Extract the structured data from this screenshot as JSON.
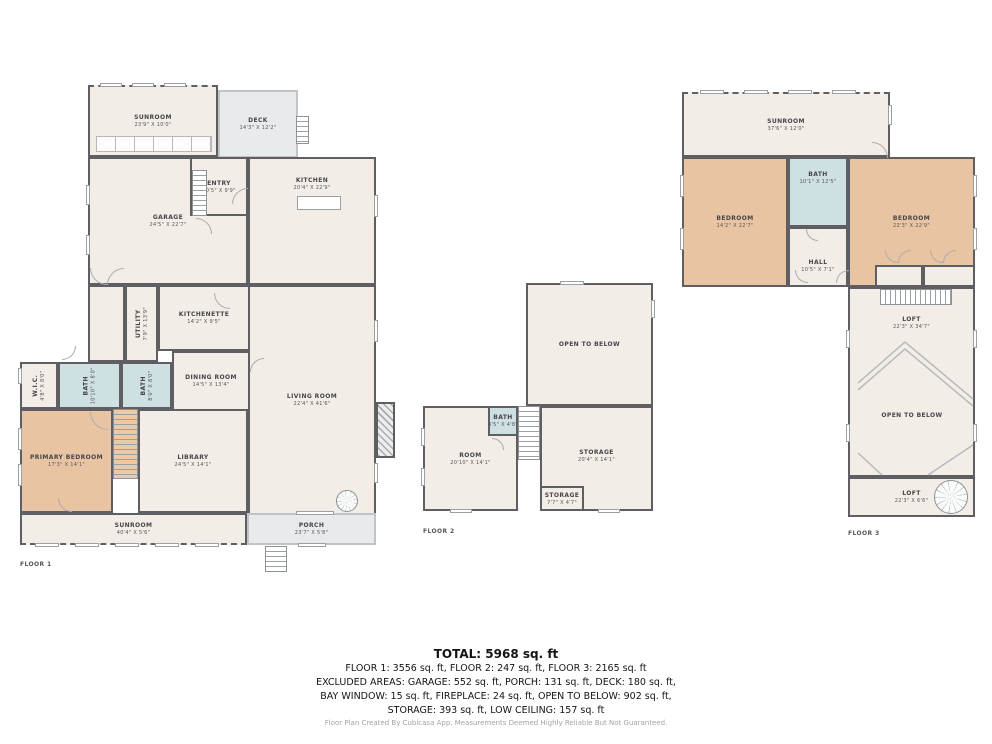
{
  "summary": {
    "total": "TOTAL: 5968 sq. ft",
    "floors_line": "FLOOR 1: 3556 sq. ft, FLOOR 2: 247 sq. ft, FLOOR 3: 2165 sq. ft",
    "excluded_line1": "EXCLUDED AREAS: GARAGE: 552 sq. ft, PORCH: 131 sq. ft, DECK: 180 sq. ft,",
    "excluded_line2": "BAY WINDOW: 15 sq. ft, FIREPLACE: 24 sq. ft, OPEN TO BELOW: 902 sq. ft,",
    "excluded_line3": "STORAGE: 393 sq. ft, LOW CEILING: 157 sq. ft",
    "footer": "Floor Plan Created By Cubicasa App. Measurements Deemed Highly Reliable But Not Guaranteed."
  },
  "colors": {
    "wall": "#5e5e63",
    "room": "#f2ede6",
    "bedroom": "#e9c4a2",
    "bath": "#cfe0e3",
    "gray": "#e9eaeb",
    "stair1": "#eccaa6"
  },
  "floors": [
    {
      "label": "FLOOR 1",
      "lx": 20,
      "ly": 561,
      "items": [
        {
          "n": "SUNROOM",
          "d": "23'9\" X 10'0\"",
          "x": 88,
          "y": 85,
          "w": 130,
          "h": 72,
          "f": "room",
          "cls": "dash-t"
        },
        {
          "n": "DECK",
          "d": "14'3\" X 12'2\"",
          "x": 218,
          "y": 90,
          "w": 80,
          "h": 68,
          "f": "gray",
          "cls": "lt"
        },
        {
          "n": "GARAGE",
          "d": "24'5\" X 22'7\"",
          "x": 88,
          "y": 157,
          "w": 160,
          "h": 128,
          "f": "room"
        },
        {
          "n": "ENTRY",
          "d": "10'5\" X 9'9\"",
          "x": 190,
          "y": 157,
          "w": 58,
          "h": 59,
          "f": "room"
        },
        {
          "n": "KITCHEN",
          "d": "20'4\" X 22'9\"",
          "x": 248,
          "y": 157,
          "w": 128,
          "h": 128,
          "f": "room",
          "ly": 14
        },
        {
          "t": "room",
          "x": 88,
          "y": 285,
          "w": 37,
          "h": 77,
          "f": "room"
        },
        {
          "n": "UTILITY",
          "d": "7'9\" X 13'9\"",
          "x": 125,
          "y": 285,
          "w": 33,
          "h": 77,
          "f": "room",
          "rot": 1
        },
        {
          "n": "KITCHENETTE",
          "d": "14'2\" X 9'5\"",
          "x": 158,
          "y": 285,
          "w": 92,
          "h": 66,
          "f": "room"
        },
        {
          "n": "DINING ROOM",
          "d": "14'5\" X 13'4\"",
          "x": 172,
          "y": 351,
          "w": 78,
          "h": 60,
          "f": "room"
        },
        {
          "n": "LIVING ROOM",
          "d": "22'4\" X 41'6\"",
          "x": 248,
          "y": 285,
          "w": 128,
          "h": 230,
          "f": "room"
        },
        {
          "n": "W.I.C.",
          "d": "4'8\" X 8'0\"",
          "x": 20,
          "y": 362,
          "w": 38,
          "h": 47,
          "f": "room",
          "rot": 1
        },
        {
          "n": "BATH",
          "d": "10'10\" X 8'0\"",
          "x": 58,
          "y": 362,
          "w": 63,
          "h": 47,
          "f": "bath",
          "rot": 1
        },
        {
          "n": "BATH",
          "d": "8'0\" X 8'0\"",
          "x": 121,
          "y": 362,
          "w": 51,
          "h": 47,
          "f": "bath",
          "rot": 1
        },
        {
          "n": "PRIMARY BEDROOM",
          "d": "17'3\" X 14'1\"",
          "x": 20,
          "y": 409,
          "w": 93,
          "h": 104,
          "f": "bedroom"
        },
        {
          "t": "stairs-v",
          "x": 113,
          "y": 409,
          "w": 25,
          "h": 70,
          "f": "stair1"
        },
        {
          "n": "LIBRARY",
          "d": "24'5\" X 14'1\"",
          "x": 138,
          "y": 409,
          "w": 110,
          "h": 104,
          "f": "room"
        },
        {
          "n": "SUNROOM",
          "d": "40'4\" X 5'6\"",
          "x": 20,
          "y": 513,
          "w": 227,
          "h": 32,
          "f": "room",
          "cls": "dash-b"
        },
        {
          "n": "PORCH",
          "d": "23'7\" X 5'8\"",
          "x": 247,
          "y": 513,
          "w": 129,
          "h": 32,
          "f": "gray",
          "cls": "lt"
        },
        {
          "t": "fireplace",
          "x": 376,
          "y": 402,
          "w": 19,
          "h": 56
        },
        {
          "t": "bench",
          "x": 96,
          "y": 136,
          "w": 116,
          "h": 16
        },
        {
          "t": "fixture",
          "x": 297,
          "y": 196,
          "w": 44,
          "h": 14
        },
        {
          "t": "stairs-v",
          "x": 192,
          "y": 170,
          "w": 15,
          "h": 46
        },
        {
          "t": "stairs-v",
          "x": 296,
          "y": 116,
          "w": 13,
          "h": 28
        },
        {
          "t": "stairs-v",
          "x": 265,
          "y": 546,
          "w": 22,
          "h": 26
        },
        {
          "t": "spiral",
          "x": 336,
          "y": 490,
          "w": 22,
          "h": 22
        },
        {
          "t": "win",
          "x": 100,
          "y": 83,
          "w": 22,
          "h": 4
        },
        {
          "t": "win",
          "x": 132,
          "y": 83,
          "w": 22,
          "h": 4
        },
        {
          "t": "win",
          "x": 164,
          "y": 83,
          "w": 22,
          "h": 4
        },
        {
          "t": "win",
          "x": 86,
          "y": 185,
          "w": 4,
          "h": 20
        },
        {
          "t": "win",
          "x": 86,
          "y": 235,
          "w": 4,
          "h": 20
        },
        {
          "t": "win",
          "x": 374,
          "y": 195,
          "w": 4,
          "h": 22
        },
        {
          "t": "win",
          "x": 374,
          "y": 320,
          "w": 4,
          "h": 22
        },
        {
          "t": "win",
          "x": 374,
          "y": 463,
          "w": 4,
          "h": 20
        },
        {
          "t": "win",
          "x": 18,
          "y": 368,
          "w": 4,
          "h": 16
        },
        {
          "t": "win",
          "x": 18,
          "y": 428,
          "w": 4,
          "h": 22
        },
        {
          "t": "win",
          "x": 18,
          "y": 464,
          "w": 4,
          "h": 22
        },
        {
          "t": "win",
          "x": 35,
          "y": 543,
          "w": 24,
          "h": 4
        },
        {
          "t": "win",
          "x": 75,
          "y": 543,
          "w": 24,
          "h": 4
        },
        {
          "t": "win",
          "x": 115,
          "y": 543,
          "w": 24,
          "h": 4
        },
        {
          "t": "win",
          "x": 155,
          "y": 543,
          "w": 24,
          "h": 4
        },
        {
          "t": "win",
          "x": 195,
          "y": 543,
          "w": 24,
          "h": 4
        },
        {
          "t": "win",
          "x": 298,
          "y": 543,
          "w": 28,
          "h": 4
        },
        {
          "t": "win",
          "x": 296,
          "y": 511,
          "w": 38,
          "h": 4
        },
        {
          "t": "arc",
          "x": 214,
          "y": 293,
          "w": 16,
          "h": 16
        },
        {
          "t": "arc",
          "x": 232,
          "y": 188,
          "w": 16,
          "h": 16,
          "r": 90
        },
        {
          "t": "arc",
          "x": 196,
          "y": 218,
          "w": 16,
          "h": 16,
          "r": 180
        },
        {
          "t": "arc",
          "x": 90,
          "y": 412,
          "w": 18,
          "h": 18
        },
        {
          "t": "arc",
          "x": 62,
          "y": 346,
          "w": 14,
          "h": 14,
          "r": 270
        },
        {
          "t": "arc",
          "x": 250,
          "y": 358,
          "w": 14,
          "h": 14,
          "r": 90
        },
        {
          "t": "arc",
          "x": 58,
          "y": 498,
          "w": 14,
          "h": 14
        },
        {
          "t": "arc",
          "x": 90,
          "y": 268,
          "w": 17,
          "h": 17
        },
        {
          "t": "arc",
          "x": 107,
          "y": 268,
          "w": 17,
          "h": 17,
          "r": 90
        }
      ]
    },
    {
      "label": "FLOOR 2",
      "lx": 423,
      "ly": 528,
      "items": [
        {
          "n": "OPEN TO BELOW",
          "x": 526,
          "y": 283,
          "w": 127,
          "h": 123,
          "f": "room"
        },
        {
          "n": "ROOM",
          "d": "20'10\" X 14'1\"",
          "x": 423,
          "y": 406,
          "w": 95,
          "h": 105,
          "f": "room"
        },
        {
          "n": "STORAGE",
          "d": "20'4\" X 14'1\"",
          "x": 540,
          "y": 406,
          "w": 113,
          "h": 105,
          "f": "room",
          "ly": 40
        },
        {
          "n": "BATH",
          "d": "4'5\" X 4'8\"",
          "x": 488,
          "y": 406,
          "w": 30,
          "h": 30,
          "f": "bath"
        },
        {
          "t": "stairs-v",
          "x": 518,
          "y": 406,
          "w": 22,
          "h": 54
        },
        {
          "n": "STORAGE",
          "d": "7'7\" X 4'7\"",
          "x": 540,
          "y": 486,
          "w": 44,
          "h": 25,
          "f": "room"
        },
        {
          "t": "win",
          "x": 421,
          "y": 428,
          "w": 4,
          "h": 18
        },
        {
          "t": "win",
          "x": 421,
          "y": 468,
          "w": 4,
          "h": 18
        },
        {
          "t": "win",
          "x": 450,
          "y": 509,
          "w": 22,
          "h": 4
        },
        {
          "t": "win",
          "x": 598,
          "y": 509,
          "w": 22,
          "h": 4
        },
        {
          "t": "win",
          "x": 560,
          "y": 281,
          "w": 24,
          "h": 4
        },
        {
          "t": "win",
          "x": 651,
          "y": 300,
          "w": 4,
          "h": 18
        },
        {
          "t": "arc",
          "x": 492,
          "y": 438,
          "w": 12,
          "h": 12,
          "r": 180
        }
      ]
    },
    {
      "label": "FLOOR 3",
      "lx": 848,
      "ly": 530,
      "items": [
        {
          "n": "SUNROOM",
          "d": "37'6\" X 12'0\"",
          "x": 682,
          "y": 92,
          "w": 208,
          "h": 65,
          "f": "room",
          "cls": "dash-t"
        },
        {
          "n": "BEDROOM",
          "d": "14'2\" X 22'7\"",
          "x": 682,
          "y": 157,
          "w": 106,
          "h": 130,
          "f": "bedroom"
        },
        {
          "n": "BATH",
          "d": "10'1\" X 12'5\"",
          "x": 788,
          "y": 157,
          "w": 60,
          "h": 70,
          "f": "bath",
          "ly": 16
        },
        {
          "n": "HALL",
          "d": "10'5\" X 7'1\"",
          "x": 788,
          "y": 227,
          "w": 60,
          "h": 60,
          "f": "room",
          "ly": 52
        },
        {
          "n": "BEDROOM",
          "d": "22'3\" X 22'9\"",
          "x": 848,
          "y": 157,
          "w": 127,
          "h": 130,
          "f": "bedroom"
        },
        {
          "t": "room",
          "x": 875,
          "y": 265,
          "w": 48,
          "h": 22,
          "f": "room"
        },
        {
          "t": "room",
          "x": 923,
          "y": 265,
          "w": 52,
          "h": 22,
          "f": "room"
        },
        {
          "n": "LOFT",
          "d": "22'3\" X 34'7\"",
          "x": 848,
          "y": 287,
          "w": 127,
          "h": 190,
          "f": "room",
          "ly": 14
        },
        {
          "t": "stairs-h",
          "x": 880,
          "y": 289,
          "w": 72,
          "h": 16
        },
        {
          "t": "label",
          "n": "OPEN TO BELOW",
          "x": 858,
          "y": 408,
          "w": 108,
          "h": 14
        },
        {
          "n": "LOFT",
          "d": "22'3\" X 6'6\"",
          "x": 848,
          "y": 477,
          "w": 127,
          "h": 40,
          "f": "room"
        },
        {
          "t": "spiral",
          "x": 934,
          "y": 480,
          "w": 34,
          "h": 34
        },
        {
          "t": "win",
          "x": 700,
          "y": 90,
          "w": 24,
          "h": 4
        },
        {
          "t": "win",
          "x": 744,
          "y": 90,
          "w": 24,
          "h": 4
        },
        {
          "t": "win",
          "x": 788,
          "y": 90,
          "w": 24,
          "h": 4
        },
        {
          "t": "win",
          "x": 832,
          "y": 90,
          "w": 24,
          "h": 4
        },
        {
          "t": "win",
          "x": 680,
          "y": 175,
          "w": 4,
          "h": 22
        },
        {
          "t": "win",
          "x": 680,
          "y": 228,
          "w": 4,
          "h": 22
        },
        {
          "t": "win",
          "x": 973,
          "y": 175,
          "w": 4,
          "h": 22
        },
        {
          "t": "win",
          "x": 973,
          "y": 228,
          "w": 4,
          "h": 22
        },
        {
          "t": "win",
          "x": 973,
          "y": 330,
          "w": 4,
          "h": 18
        },
        {
          "t": "win",
          "x": 973,
          "y": 424,
          "w": 4,
          "h": 18
        },
        {
          "t": "win",
          "x": 846,
          "y": 330,
          "w": 4,
          "h": 18
        },
        {
          "t": "win",
          "x": 846,
          "y": 424,
          "w": 4,
          "h": 18
        },
        {
          "t": "win",
          "x": 888,
          "y": 105,
          "w": 4,
          "h": 20
        },
        {
          "t": "arc",
          "x": 872,
          "y": 142,
          "w": 16,
          "h": 16,
          "r": 180
        },
        {
          "t": "arc",
          "x": 795,
          "y": 270,
          "w": 13,
          "h": 13
        },
        {
          "t": "arc",
          "x": 836,
          "y": 270,
          "w": 13,
          "h": 13,
          "r": 90
        },
        {
          "t": "arc",
          "x": 806,
          "y": 229,
          "w": 12,
          "h": 12
        },
        {
          "t": "arc",
          "x": 885,
          "y": 250,
          "w": 13,
          "h": 13
        },
        {
          "t": "arc",
          "x": 898,
          "y": 250,
          "w": 13,
          "h": 13,
          "r": 90
        },
        {
          "t": "arc",
          "x": 930,
          "y": 250,
          "w": 13,
          "h": 13
        },
        {
          "t": "arc",
          "x": 943,
          "y": 250,
          "w": 13,
          "h": 13,
          "r": 90
        }
      ]
    }
  ]
}
